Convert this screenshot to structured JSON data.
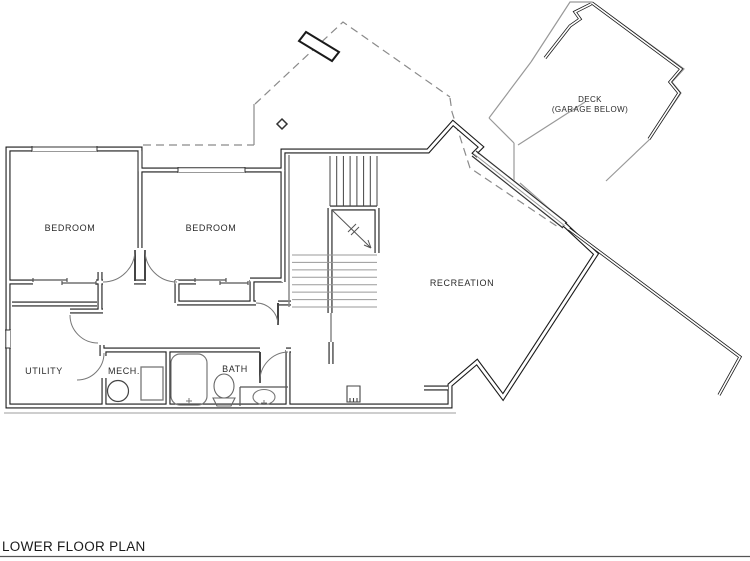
{
  "drawing": {
    "title": "LOWER FLOOR PLAN",
    "rooms": {
      "bedroom1": "BEDROOM",
      "bedroom2": "BEDROOM",
      "utility": "UTILITY",
      "mech": "MECH.",
      "bath": "BATH",
      "recreation": "RECREATION",
      "deck_line1": "DECK",
      "deck_line2": "(GARAGE BELOW)"
    },
    "colors": {
      "wall": "#1a1a1a",
      "thin": "#555555",
      "light": "#999999",
      "background": "#ffffff"
    }
  }
}
